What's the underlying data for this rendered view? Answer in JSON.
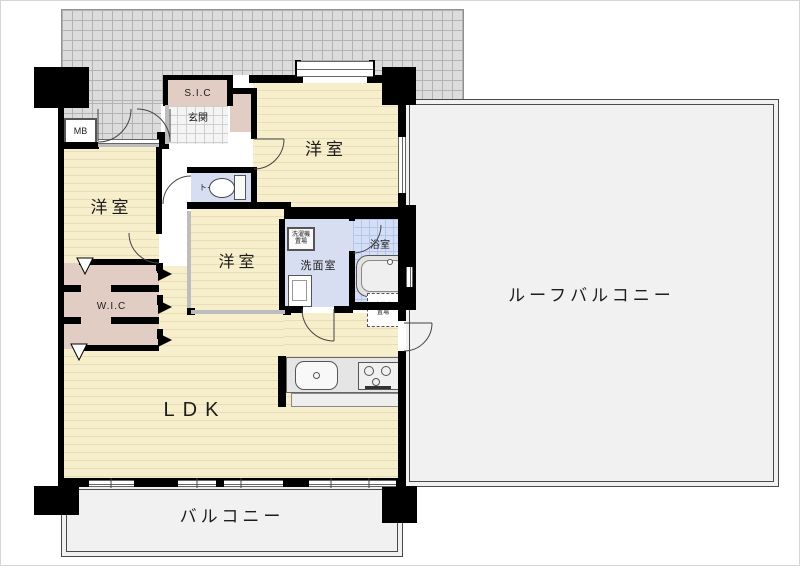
{
  "plan_title": "apartment-floor-plan",
  "rooms": {
    "bedroom_left": {
      "label": "洋室"
    },
    "bedroom_center": {
      "label": "洋室"
    },
    "bedroom_right": {
      "label": "洋室"
    },
    "ldk": {
      "label": "LDK"
    },
    "wic": {
      "label": "W.I.C"
    },
    "sic": {
      "label": "S.I.C"
    },
    "genkan": {
      "label": "玄関"
    },
    "toilet": {
      "label": "トイレ"
    },
    "washroom": {
      "label": "洗面室"
    },
    "bath": {
      "label": "浴室"
    },
    "mb": {
      "label": "MB"
    },
    "balcony": {
      "label": "バルコニー"
    },
    "roof_balcony": {
      "label": "ルーフバルコニー"
    }
  },
  "fixtures": {
    "washer_space": {
      "line1": "洗濯機",
      "line2": "置場"
    },
    "fridge_space": {
      "line1": "冷蔵庫",
      "line2": "置場"
    }
  },
  "colors": {
    "floor_cream": "#f7eecb",
    "floor_stripe": "#e9ddb8",
    "closet_pink": "#e2cdc5",
    "wet_room_blue": "#d8def1",
    "bath_tile_blue": "#d4dff6",
    "balcony_gray": "#f1f1f1",
    "common_hatch_gray": "#dcdcdc",
    "wall_black": "#000000"
  }
}
